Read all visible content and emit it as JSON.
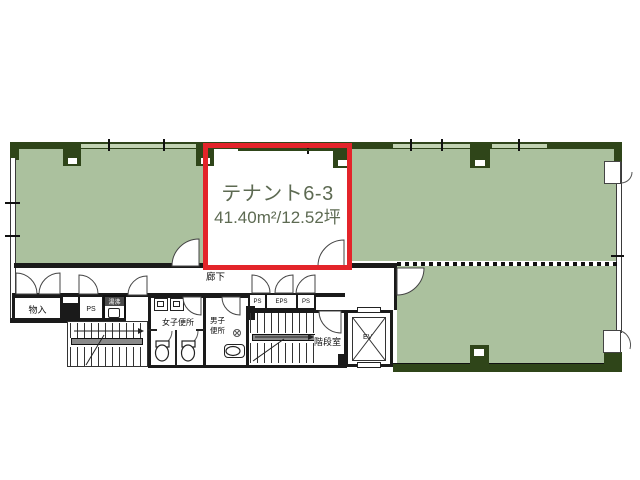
{
  "colors": {
    "floor_green": "#abc19e",
    "wall_green": "#2f4519",
    "highlight_red": "#e3242a",
    "tenant_label_color": "#5d6a52",
    "wall_black": "#1a1a1a"
  },
  "highlighted_tenant": {
    "name": "テナント6-3",
    "area": "41.40m²/12.52坪"
  },
  "labels": {
    "corridor": "廊下",
    "storage": "物入",
    "pipe_shaft": "PS",
    "hot_water": "湯沸",
    "womens_toilet": "女子便所",
    "mens_toilet_line1": "男子",
    "mens_toilet_line2": "便所",
    "shaft_row": [
      "PS",
      "EPS",
      "PS"
    ],
    "stairwell": "階段室",
    "elevator": "EV"
  }
}
